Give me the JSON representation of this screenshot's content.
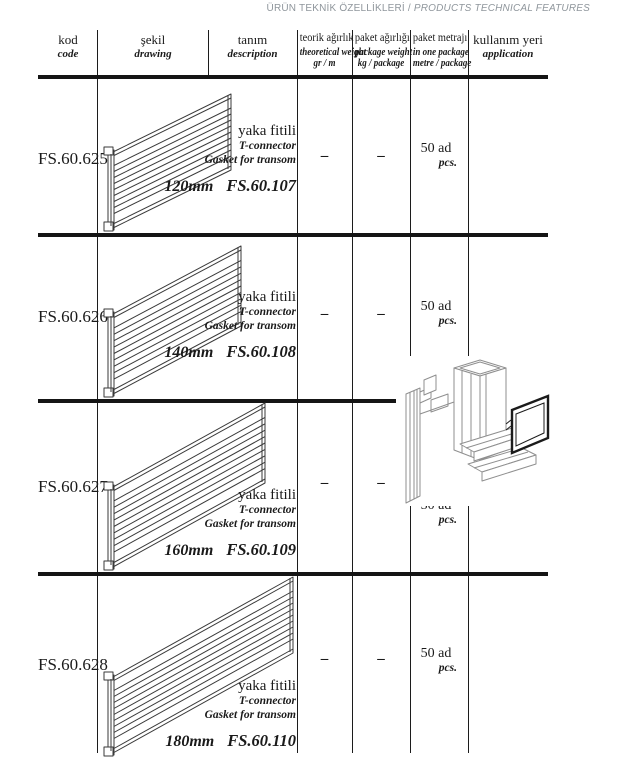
{
  "page_title": {
    "tr": "ÜRÜN TEKNİK ÖZELLİKLERİ /",
    "en": "PRODUCTS TECHNICAL FEATURES"
  },
  "table": {
    "headers": [
      {
        "tr": "kod",
        "en": "code",
        "unit": ""
      },
      {
        "tr": "şekil",
        "en": "drawing",
        "unit": ""
      },
      {
        "tr": "tanım",
        "en": "description",
        "unit": ""
      },
      {
        "tr": "teorik ağırlık",
        "en": "theoretical weight",
        "unit": "gr / m"
      },
      {
        "tr": "paket ağırlığı",
        "en": "package weight",
        "unit": "kg / package"
      },
      {
        "tr": "paket metrajı",
        "en": "in one package",
        "unit": "metre / package"
      },
      {
        "tr": "kullanım yeri",
        "en": "application",
        "unit": ""
      }
    ],
    "rows": [
      {
        "code": "FS.60.625",
        "size": "120mm",
        "desc_tr": "yaka fitili",
        "desc_en_1": "T-connector",
        "desc_en_2": "Gasket for transom",
        "part_code": "FS.60.107",
        "theoretical_weight": "–",
        "package_weight": "–",
        "package_qty_tr": "50 ad",
        "package_qty_en": "pcs."
      },
      {
        "code": "FS.60.626",
        "size": "140mm",
        "desc_tr": "yaka fitili",
        "desc_en_1": "T-connector",
        "desc_en_2": "Gasket for transom",
        "part_code": "FS.60.108",
        "theoretical_weight": "–",
        "package_weight": "–",
        "package_qty_tr": "50 ad",
        "package_qty_en": "pcs."
      },
      {
        "code": "FS.60.627",
        "size": "160mm",
        "desc_tr": "yaka fitili",
        "desc_en_1": "T-connector",
        "desc_en_2": "Gasket for transom",
        "part_code": "FS.60.109",
        "theoretical_weight": "–",
        "package_weight": "–",
        "package_qty_tr": "50 ad",
        "package_qty_en": "pcs."
      },
      {
        "code": "FS.60.628",
        "size": "180mm",
        "desc_tr": "yaka fitili",
        "desc_en_1": "T-connector",
        "desc_en_2": "Gasket for transom",
        "part_code": "FS.60.110",
        "theoretical_weight": "–",
        "package_weight": "–",
        "package_qty_tr": "50 ad",
        "package_qty_en": "pcs."
      }
    ]
  }
}
